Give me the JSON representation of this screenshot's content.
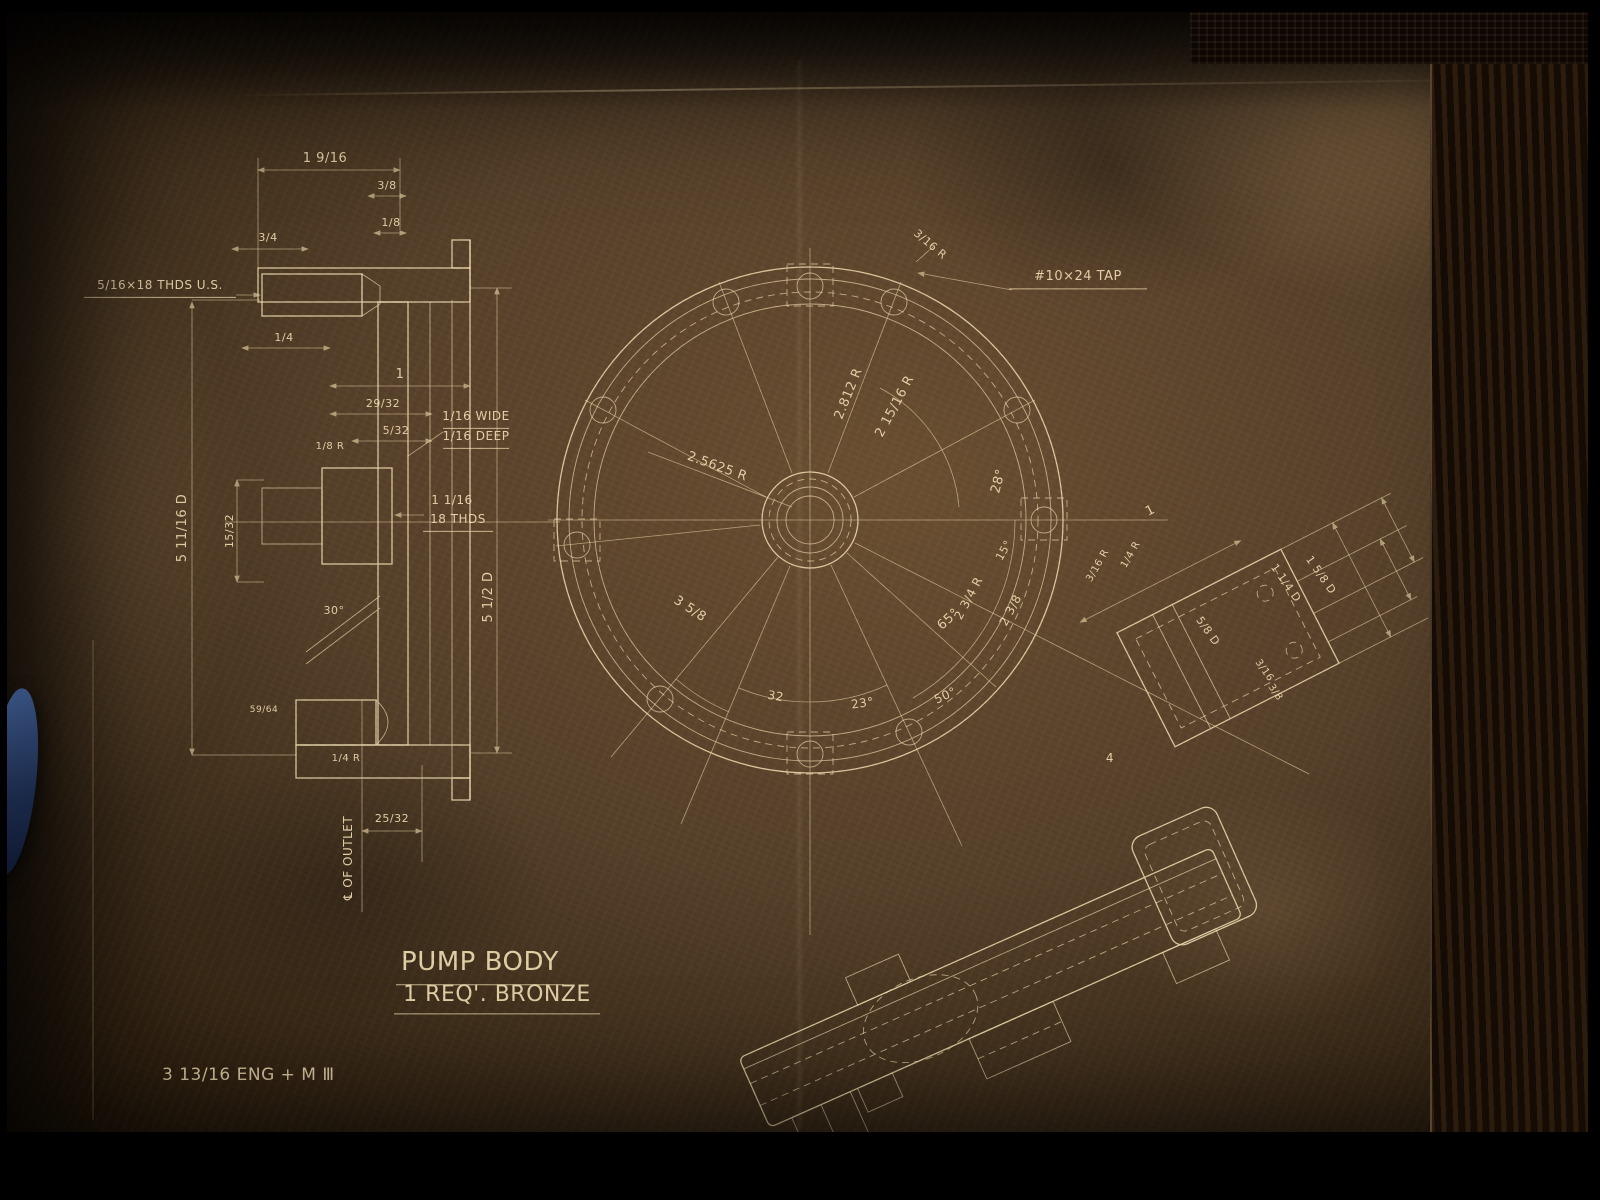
{
  "photo": {
    "kind": "photograph of vintage engineering blueprint",
    "line_color": "#ecd9ae",
    "paper_tint": "#55402a",
    "frame_color": "#000000",
    "foreign_object": "blue-clip-left-edge"
  },
  "drawing_title": "Pump Body",
  "drawing_subtitle": "1 Req'.  Bronze",
  "footer_note": "3 13/16 ENG + M III",
  "views": {
    "left": "sectional-elevation-of-pump-body",
    "center": "circular-plan-view-with-bolt-circle",
    "right": "rotated-outlet-flange-plan",
    "bottom_right": "rotated-outlet-side-view"
  },
  "labels": [
    {
      "t": "1 9/16",
      "x": 325,
      "y": 162
    },
    {
      "t": "3/8",
      "x": 387,
      "y": 189,
      "s": 11
    },
    {
      "t": "1/8",
      "x": 391,
      "y": 226,
      "s": 11
    },
    {
      "t": "3/4",
      "x": 268,
      "y": 241,
      "s": 11
    },
    {
      "t": "5/16×18 THDS U.S.",
      "x": 160,
      "y": 289,
      "s": 12,
      "u": 152,
      "n": "thread-callout-top-boss"
    },
    {
      "t": "1/4",
      "x": 284,
      "y": 341,
      "s": 11
    },
    {
      "t": "1",
      "x": 400,
      "y": 378
    },
    {
      "t": "29/32",
      "x": 383,
      "y": 407,
      "s": 11
    },
    {
      "t": "5/32",
      "x": 396,
      "y": 434,
      "s": 11
    },
    {
      "t": "1/8 R",
      "x": 330,
      "y": 449,
      "s": 10
    },
    {
      "t": "1/16 WIDE",
      "x": 476,
      "y": 420,
      "s": 12,
      "u": 66,
      "n": "groove-callout"
    },
    {
      "t": "1/16 DEEP",
      "x": 476,
      "y": 440,
      "s": 12,
      "u": 66,
      "n": "groove-callout"
    },
    {
      "t": "1 1/16",
      "x": 452,
      "y": 504,
      "s": 12
    },
    {
      "t": "18 THDS",
      "x": 458,
      "y": 523,
      "s": 12,
      "u": 70,
      "n": "thread-callout-center-bore"
    },
    {
      "t": "5 11/16 D",
      "x": 186,
      "y": 528,
      "r": -90,
      "n": "overall-depth-dim"
    },
    {
      "t": "15/32",
      "x": 233,
      "y": 531,
      "r": -90,
      "s": 11
    },
    {
      "t": "5 1/2 D",
      "x": 492,
      "y": 597,
      "r": -90,
      "n": "overall-height-dim"
    },
    {
      "t": "30°",
      "x": 334,
      "y": 614,
      "s": 11
    },
    {
      "t": "1/4 R",
      "x": 346,
      "y": 761,
      "s": 10
    },
    {
      "t": "59/64",
      "x": 264,
      "y": 712,
      "s": 9
    },
    {
      "t": "25/32",
      "x": 392,
      "y": 822,
      "s": 11
    },
    {
      "t": "℄ OF OUTLET",
      "x": 352,
      "y": 858,
      "r": -90,
      "s": 12,
      "n": "outlet-centerline-label"
    },
    {
      "t": "3/16 R",
      "x": 928,
      "y": 247,
      "r": 40,
      "s": 11
    },
    {
      "t": "#10×24 TAP",
      "x": 1078,
      "y": 280,
      "s": 13,
      "u": 138,
      "n": "tap-callout"
    },
    {
      "t": "2.812 R",
      "x": 852,
      "y": 395,
      "r": -68,
      "n": "radius-dim"
    },
    {
      "t": "2 15/16 R",
      "x": 898,
      "y": 408,
      "r": -62,
      "n": "radius-dim"
    },
    {
      "t": "2.5625 R",
      "x": 716,
      "y": 470,
      "r": 20,
      "n": "radius-dim"
    },
    {
      "t": "28°",
      "x": 1002,
      "y": 482,
      "r": -75
    },
    {
      "t": "15°",
      "x": 1007,
      "y": 552,
      "r": -60,
      "s": 11
    },
    {
      "t": "1/4 R",
      "x": 1133,
      "y": 556,
      "r": -60,
      "s": 10
    },
    {
      "t": "3/16 R",
      "x": 1100,
      "y": 567,
      "r": -60,
      "s": 10
    },
    {
      "t": "2 3/4 R",
      "x": 972,
      "y": 600,
      "r": -62,
      "s": 12,
      "n": "radius-dim"
    },
    {
      "t": "2 3/8",
      "x": 1014,
      "y": 612,
      "r": -62,
      "s": 12
    },
    {
      "t": "65°",
      "x": 951,
      "y": 622,
      "r": -42
    },
    {
      "t": "3 5/8",
      "x": 688,
      "y": 612,
      "r": 33,
      "n": "radius-dim"
    },
    {
      "t": "32",
      "x": 775,
      "y": 700,
      "r": 10,
      "s": 12
    },
    {
      "t": "23°",
      "x": 863,
      "y": 707,
      "r": -8,
      "s": 12
    },
    {
      "t": "50°",
      "x": 947,
      "y": 699,
      "r": -25,
      "s": 12
    },
    {
      "t": "1",
      "x": 1152,
      "y": 514,
      "r": -27
    },
    {
      "t": "1 5/8 D",
      "x": 1318,
      "y": 577,
      "r": 55,
      "s": 11
    },
    {
      "t": "1 1/4 D",
      "x": 1283,
      "y": 585,
      "r": 55,
      "s": 11
    },
    {
      "t": "5/8 D",
      "x": 1205,
      "y": 633,
      "r": 55,
      "s": 11
    },
    {
      "t": "3/16",
      "x": 1262,
      "y": 672,
      "r": 55,
      "s": 10
    },
    {
      "t": "3/8",
      "x": 1273,
      "y": 694,
      "r": 55,
      "s": 10
    },
    {
      "t": "4",
      "x": 1110,
      "y": 762,
      "s": 12
    },
    {
      "t": "PUMP BODY",
      "x": 480,
      "y": 970,
      "s": 26,
      "ls": 4,
      "u": 168,
      "n": "drawing-title"
    },
    {
      "t": "1 REQ'.  BRONZE",
      "x": 497,
      "y": 1001,
      "s": 22,
      "ls": 2,
      "u": 206,
      "n": "drawing-subtitle"
    },
    {
      "t": "3 13/16 ENG + M Ⅲ",
      "x": 162,
      "y": 1080,
      "s": 17,
      "a": "start",
      "n": "footer-note"
    }
  ]
}
